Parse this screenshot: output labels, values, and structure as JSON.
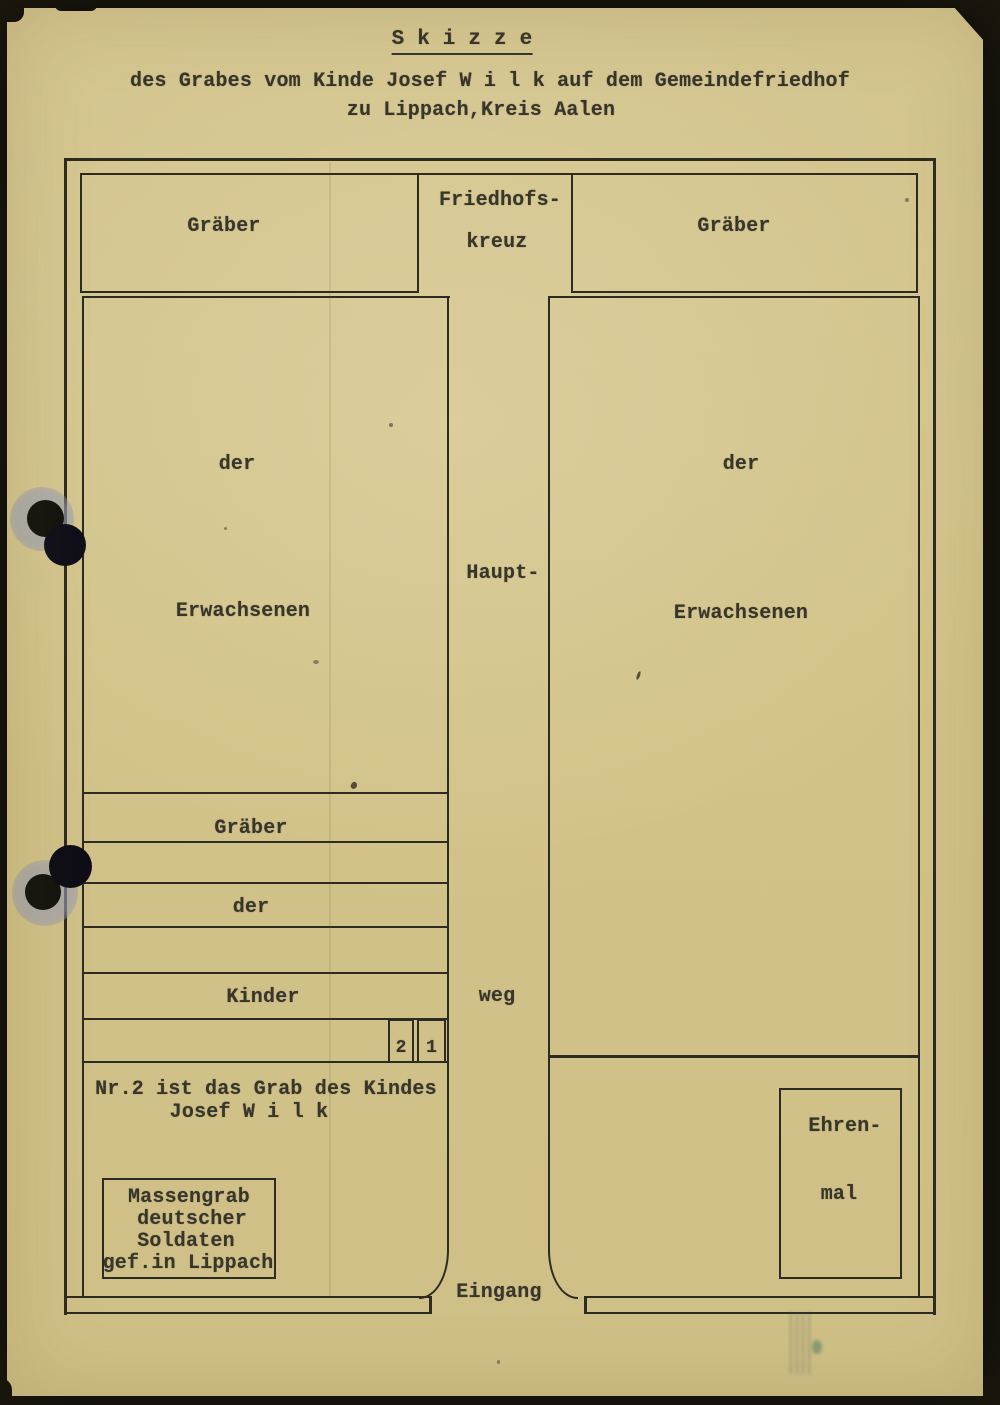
{
  "document": {
    "title": "S k i z z e",
    "subtitle_line1": "des Grabes vom Kinde Josef W i l k auf dem Gemeindefriedhof",
    "subtitle_line2": "zu Lippach,Kreis Aalen"
  },
  "plan": {
    "top_row": {
      "left_graves": "Gräber",
      "cross_line1": "Friedhofs-",
      "cross_line2": "kreuz",
      "right_graves": "Gräber"
    },
    "left_field": {
      "word1": "der",
      "word2": "Erwachsenen"
    },
    "right_field": {
      "word1": "der",
      "word2": "Erwachsenen"
    },
    "main_path": {
      "word1": "Haupt-",
      "word2": "weg"
    },
    "child_rows": {
      "row1": "Gräber",
      "row2": "der",
      "row3": "Kinder"
    },
    "graves": {
      "number_2": "2",
      "number_1": "1"
    },
    "note_line1": "Nr.2 ist das Grab des Kindes",
    "note_line2": "Josef W i l k",
    "mass_grave": {
      "line1": "Massengrab",
      "line2": "deutscher",
      "line3": "Soldaten",
      "line4": "gef.in Lippach"
    },
    "memorial": {
      "line1": "Ehren-",
      "line2": "mal"
    },
    "entrance": "Eingang"
  },
  "colors": {
    "paper": "#d2c38c",
    "ink": "#36342a",
    "line": "#2e2c22"
  }
}
